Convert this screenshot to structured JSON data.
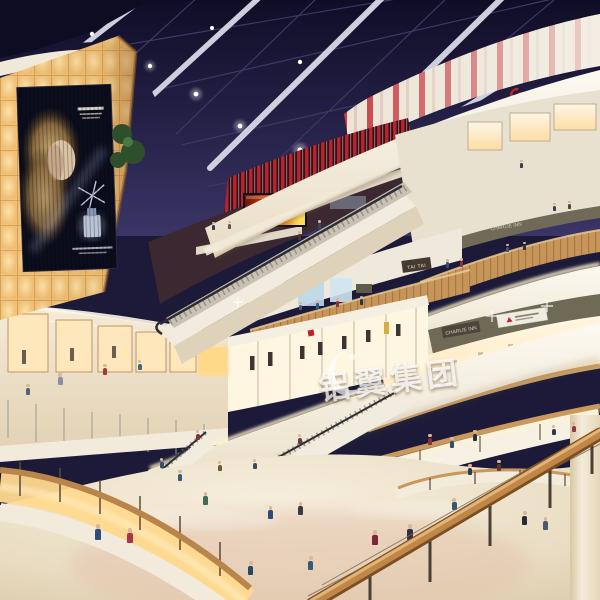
{
  "scene": {
    "description": "Night-time interior rendering of a multi-level shopping mall atrium with skylight, escalators, shops and crowds",
    "signs": {
      "theatres": "THEATRES",
      "tai_tai": "TAI TAI",
      "store_fascia": "CHARLIE INN"
    },
    "watermark": {
      "text": "铝翼集团"
    },
    "billboard": {
      "type": "backlit perfume advertisement"
    },
    "colors": {
      "sky": "#201d40",
      "theatre_red": "#c1202b",
      "amber_wall": "#f2c378",
      "fascia_cream": "#f5efe2",
      "wood": "#c08748",
      "floor": "#e9dcc4",
      "fire_screen": "#e06010",
      "glow": "#ffdf9e"
    }
  }
}
